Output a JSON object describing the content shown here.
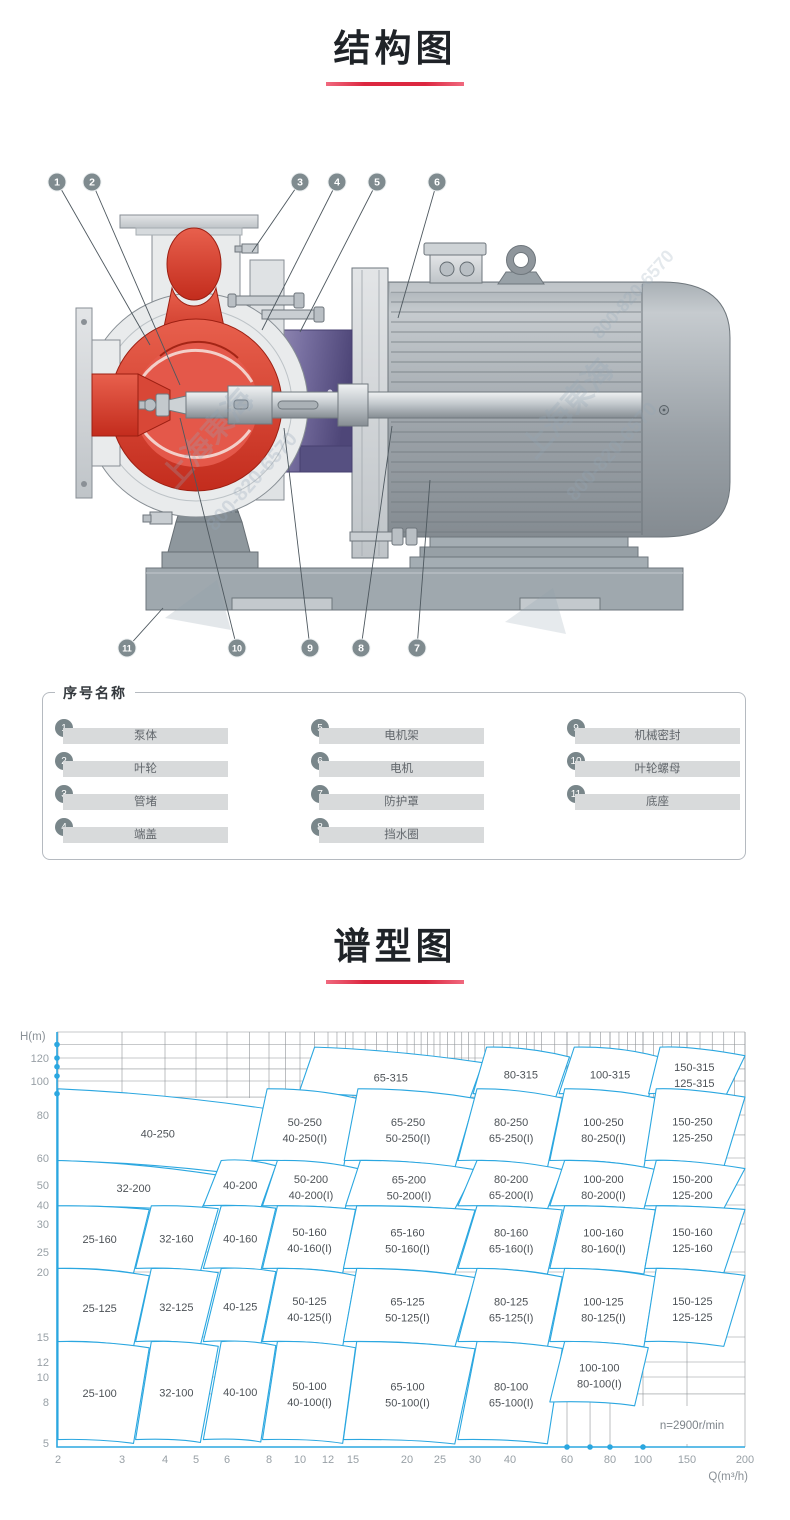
{
  "structure_section": {
    "title": "结构图"
  },
  "chart_section": {
    "title": "谱型图"
  },
  "diagram": {
    "callouts_top": [
      "1",
      "2",
      "3",
      "4",
      "5",
      "6"
    ],
    "callouts_bottom": [
      "11",
      "10",
      "9",
      "8",
      "7"
    ],
    "watermark": {
      "name": "上海東海",
      "phone": "800-820-6570"
    },
    "colors": {
      "pump_red": "#d6392b",
      "housing_purple": "#6c6496",
      "metal_gray": "#9aa1a7"
    }
  },
  "legend": {
    "title": "序号名称",
    "items": [
      {
        "num": "1",
        "label": "泵体"
      },
      {
        "num": "2",
        "label": "叶轮"
      },
      {
        "num": "3",
        "label": "管堵"
      },
      {
        "num": "4",
        "label": "端盖"
      },
      {
        "num": "5",
        "label": "电机架"
      },
      {
        "num": "6",
        "label": "电机"
      },
      {
        "num": "7",
        "label": "防护罩"
      },
      {
        "num": "8",
        "label": "挡水圈"
      },
      {
        "num": "9",
        "label": "机械密封"
      },
      {
        "num": "10",
        "label": "叶轮螺母"
      },
      {
        "num": "11",
        "label": "底座"
      }
    ]
  },
  "chart_data": {
    "type": "heatmap",
    "subtype": "pump-selection-region-map",
    "title": "谱型图",
    "xlabel": "Q(m³/h)",
    "ylabel": "H(m)",
    "scale": "log-log",
    "x_range": [
      2,
      200
    ],
    "y_range": [
      5,
      140
    ],
    "x_ticks": [
      2,
      3,
      4,
      5,
      6,
      8,
      10,
      12,
      15,
      20,
      25,
      30,
      40,
      60,
      80,
      100,
      150,
      200
    ],
    "y_ticks": [
      5,
      8,
      10,
      12,
      15,
      20,
      25,
      30,
      40,
      50,
      60,
      80,
      100,
      120
    ],
    "annotation": "n=2900r/min",
    "accent": "#2ba7e0",
    "grid": true,
    "axis_dots_h": [
      130,
      120,
      112,
      104,
      92
    ],
    "axis_dots_q": [
      60,
      70,
      80,
      100
    ],
    "rows": [
      {
        "h": [
          92,
          128
        ],
        "cells": [
          {
            "q": [
              11,
              32
            ],
            "labels": [
              "65-315"
            ]
          },
          {
            "q": [
              33,
              61
            ],
            "labels": [
              "80-315"
            ]
          },
          {
            "q": [
              63,
              116
            ],
            "labels": [
              "100-315"
            ]
          },
          {
            "q": [
              117,
              200
            ],
            "labels": [
              "150-315",
              "125-315"
            ]
          }
        ]
      },
      {
        "h": [
          59,
          95
        ],
        "cells": [
          {
            "q": [
              2,
              7.8
            ],
            "labels": [
              "40-250"
            ]
          },
          {
            "q": [
              7.9,
              15.3
            ],
            "labels": [
              "50-250",
              "40-250(I)"
            ]
          },
          {
            "q": [
              15.4,
              30
            ],
            "labels": [
              "65-250",
              "50-250(I)"
            ]
          },
          {
            "q": [
              30.5,
              58
            ],
            "labels": [
              "80-250",
              "65-250(I)"
            ]
          },
          {
            "q": [
              59,
              112
            ],
            "labels": [
              "100-250",
              "80-250(I)"
            ]
          },
          {
            "q": [
              113,
              200
            ],
            "labels": [
              "150-250",
              "125-250"
            ]
          }
        ]
      },
      {
        "h": [
          39.5,
          59
        ],
        "cells": [
          {
            "q": [
              2,
              5.7
            ],
            "labels": [
              "32-200"
            ]
          },
          {
            "q": [
              5.8,
              8.4
            ],
            "labels": [
              "40-200"
            ]
          },
          {
            "q": [
              8.5,
              15.5
            ],
            "labels": [
              "50-200",
              "40-200(I)"
            ]
          },
          {
            "q": [
              15.6,
              30
            ],
            "labels": [
              "65-200",
              "50-200(I)"
            ]
          },
          {
            "q": [
              30.5,
              58
            ],
            "labels": [
              "80-200",
              "65-200(I)"
            ]
          },
          {
            "q": [
              59,
              112
            ],
            "labels": [
              "100-200",
              "80-200(I)"
            ]
          },
          {
            "q": [
              113,
              200
            ],
            "labels": [
              "150-200",
              "125-200"
            ]
          }
        ]
      },
      {
        "h": [
          20.8,
          39.5
        ],
        "cells": [
          {
            "q": [
              2,
              3.6
            ],
            "labels": [
              "25-160"
            ]
          },
          {
            "q": [
              3.65,
              5.7
            ],
            "labels": [
              "32-160"
            ]
          },
          {
            "q": [
              5.8,
              8.4
            ],
            "labels": [
              "40-160"
            ]
          },
          {
            "q": [
              8.5,
              15.2
            ],
            "labels": [
              "50-160",
              "40-160(I)"
            ]
          },
          {
            "q": [
              15.3,
              30
            ],
            "labels": [
              "65-160",
              "50-160(I)"
            ]
          },
          {
            "q": [
              30.5,
              58
            ],
            "labels": [
              "80-160",
              "65-160(I)"
            ]
          },
          {
            "q": [
              59,
              112
            ],
            "labels": [
              "100-160",
              "80-160(I)"
            ]
          },
          {
            "q": [
              113,
              200
            ],
            "labels": [
              "150-160",
              "125-160"
            ]
          }
        ]
      },
      {
        "h": [
          14.4,
          20.8
        ],
        "cells": [
          {
            "q": [
              2,
              3.6
            ],
            "labels": [
              "25-125"
            ]
          },
          {
            "q": [
              3.65,
              5.7
            ],
            "labels": [
              "32-125"
            ]
          },
          {
            "q": [
              5.8,
              8.4
            ],
            "labels": [
              "40-125"
            ]
          },
          {
            "q": [
              8.5,
              15.2
            ],
            "labels": [
              "50-125",
              "40-125(I)"
            ]
          },
          {
            "q": [
              15.3,
              30
            ],
            "labels": [
              "65-125",
              "50-125(I)"
            ]
          },
          {
            "q": [
              30.5,
              58
            ],
            "labels": [
              "80-125",
              "65-125(I)"
            ]
          },
          {
            "q": [
              59,
              112
            ],
            "labels": [
              "100-125",
              "80-125(I)"
            ]
          },
          {
            "q": [
              113,
              200
            ],
            "labels": [
              "150-125",
              "125-125"
            ]
          }
        ]
      },
      {
        "h": [
          5.2,
          14.4
        ],
        "cells": [
          {
            "q": [
              2,
              3.6
            ],
            "labels": [
              "25-100"
            ]
          },
          {
            "q": [
              3.65,
              5.7
            ],
            "labels": [
              "32-100"
            ]
          },
          {
            "q": [
              5.8,
              8.4
            ],
            "labels": [
              "40-100"
            ]
          },
          {
            "q": [
              8.5,
              15.2
            ],
            "labels": [
              "50-100",
              "40-100(I)"
            ]
          },
          {
            "q": [
              15.3,
              30
            ],
            "labels": [
              "65-100",
              "50-100(I)"
            ]
          },
          {
            "q": [
              30.5,
              58
            ],
            "labels": [
              "80-100",
              "65-100(I)"
            ]
          },
          {
            "q": [
              59,
              105
            ],
            "labels": [
              "100-100",
              "80-100(I)"
            ],
            "h": [
              8,
              14.4
            ]
          }
        ]
      }
    ]
  }
}
